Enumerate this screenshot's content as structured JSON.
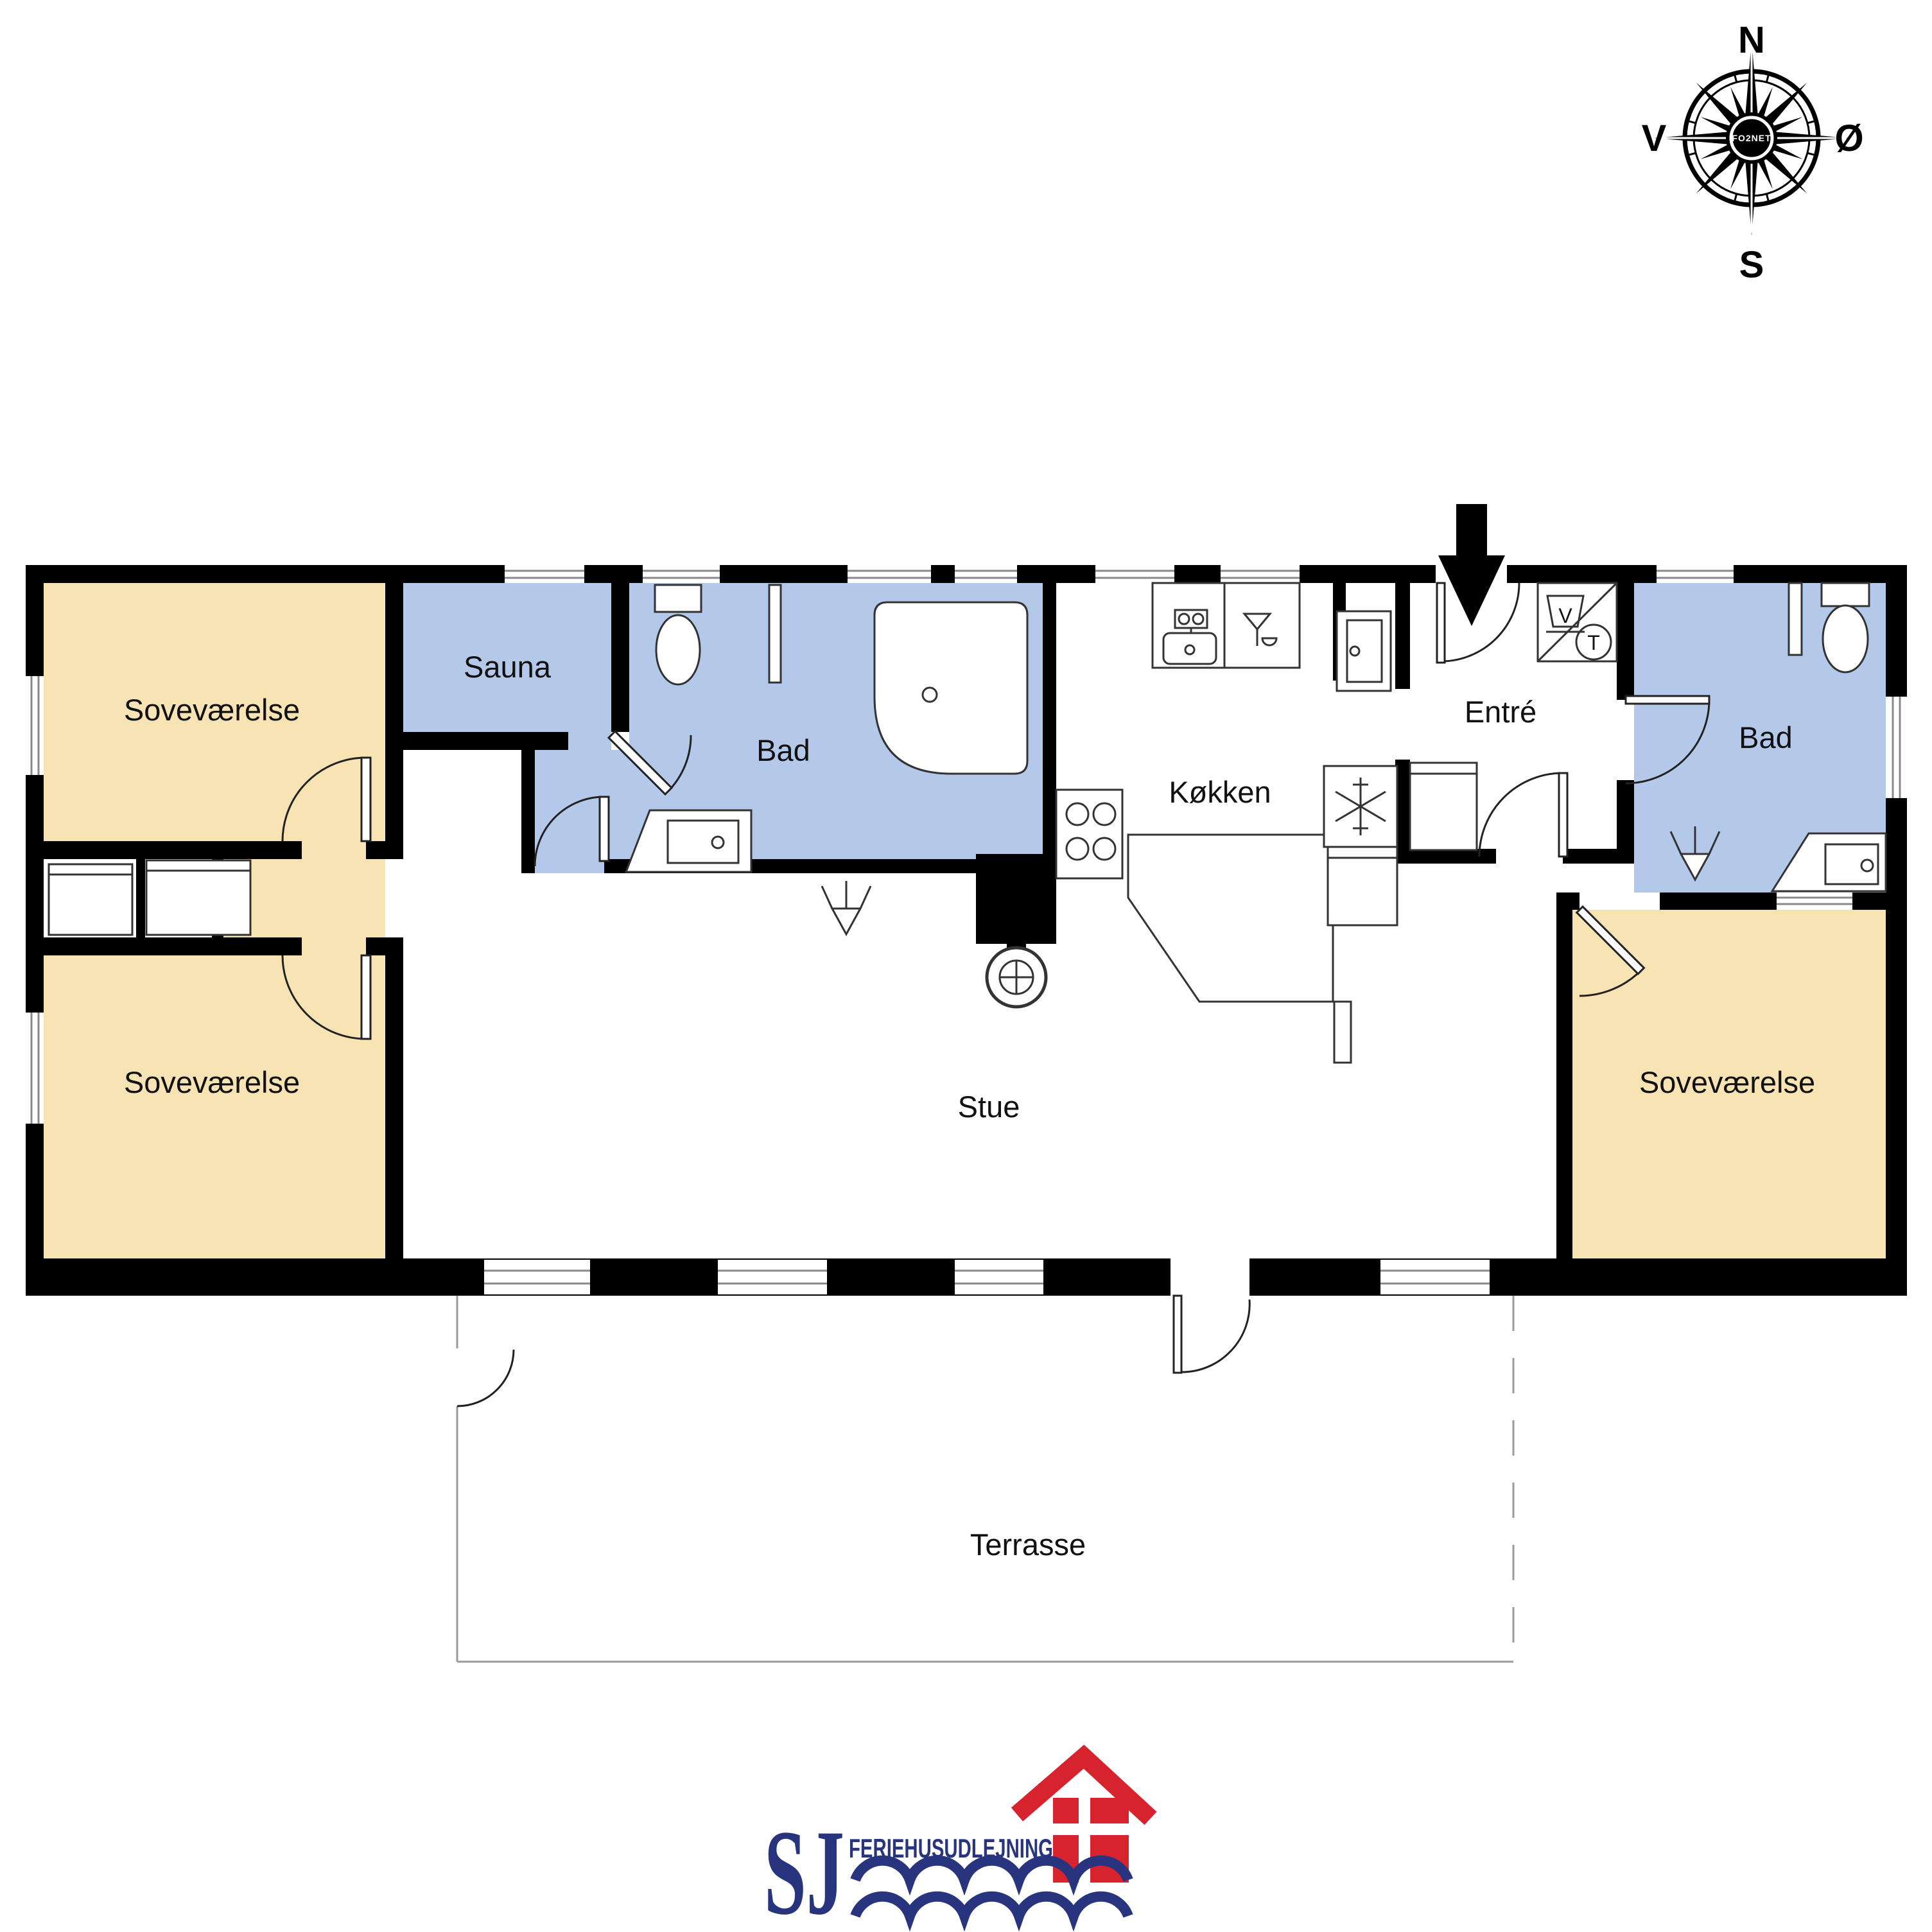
{
  "compass": {
    "north": "N",
    "east": "Ø",
    "south": "S",
    "west": "V",
    "watermark": "FO2NET"
  },
  "floorplan": {
    "wall_color": "#000000",
    "rooms": {
      "bedroom_nw": {
        "label": "Soveværelse",
        "color": "#F8E3B4"
      },
      "bedroom_sw": {
        "label": "Soveværelse",
        "color": "#F8E3B4"
      },
      "bedroom_se": {
        "label": "Soveværelse",
        "color": "#F8E3B4"
      },
      "hall": {
        "label": "",
        "color": "#F8E3B4"
      },
      "sauna": {
        "label": "Sauna",
        "color": "#B4C9E9"
      },
      "bath_main": {
        "label": "Bad",
        "color": "#B4C9E9"
      },
      "bath_second": {
        "label": "Bad",
        "color": "#B4C9E9"
      },
      "kitchen": {
        "label": "Køkken",
        "color": "#FFFFFF"
      },
      "entry": {
        "label": "Entré",
        "color": "#FFFFFF"
      },
      "living_room": {
        "label": "Stue",
        "color": "#FFFFFF"
      },
      "terrace": {
        "label": "Terrasse",
        "color": "#FFFFFF"
      }
    },
    "appliance_symbols": {
      "washer": "V",
      "dryer": "T"
    }
  },
  "logo": {
    "monogram": "SJ",
    "wordmark": "FERIEHUSUDLEJNING",
    "blue": "#28357E",
    "red": "#D6232E"
  }
}
